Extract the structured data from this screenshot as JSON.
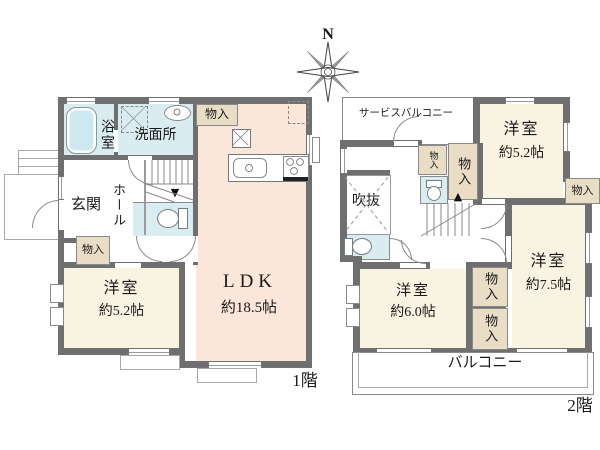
{
  "compass": {
    "north": "N"
  },
  "floor1": {
    "floor_label": "1階",
    "bath": "浴室",
    "washroom": "洗面所",
    "closet_washroom": "物入",
    "hall": "ホール",
    "entrance": "玄関",
    "closet_hall": "物入",
    "ldk": "LDK",
    "ldk_size": "約18.5帖",
    "bedroom": "洋室",
    "bedroom_size": "約5.2帖",
    "stairs_arrow": "▼"
  },
  "floor2": {
    "floor_label": "2階",
    "service_balcony": "サービスバルコニー",
    "bedroom_a": "洋室",
    "bedroom_a_size": "約5.2帖",
    "closet_hall_small": "物入",
    "closet_hall_large": "物入",
    "closet_east": "物入",
    "void": "吹抜",
    "bedroom_b": "洋室",
    "bedroom_b_size": "約6.0帖",
    "bedroom_c": "洋室",
    "bedroom_c_size": "約7.5帖",
    "closet_mid_upper": "物入",
    "closet_mid_lower": "物入",
    "balcony": "バルコニー",
    "stairs_arrow": "▲"
  },
  "colors": {
    "wall": "#6f6f6f",
    "bedroom_fill": "#f8f4e1",
    "ldk_fill": "#fbe7da",
    "water_fill": "#d9edf1",
    "closet_fill": "#e9ddc6",
    "line": "#8a8a8a"
  }
}
